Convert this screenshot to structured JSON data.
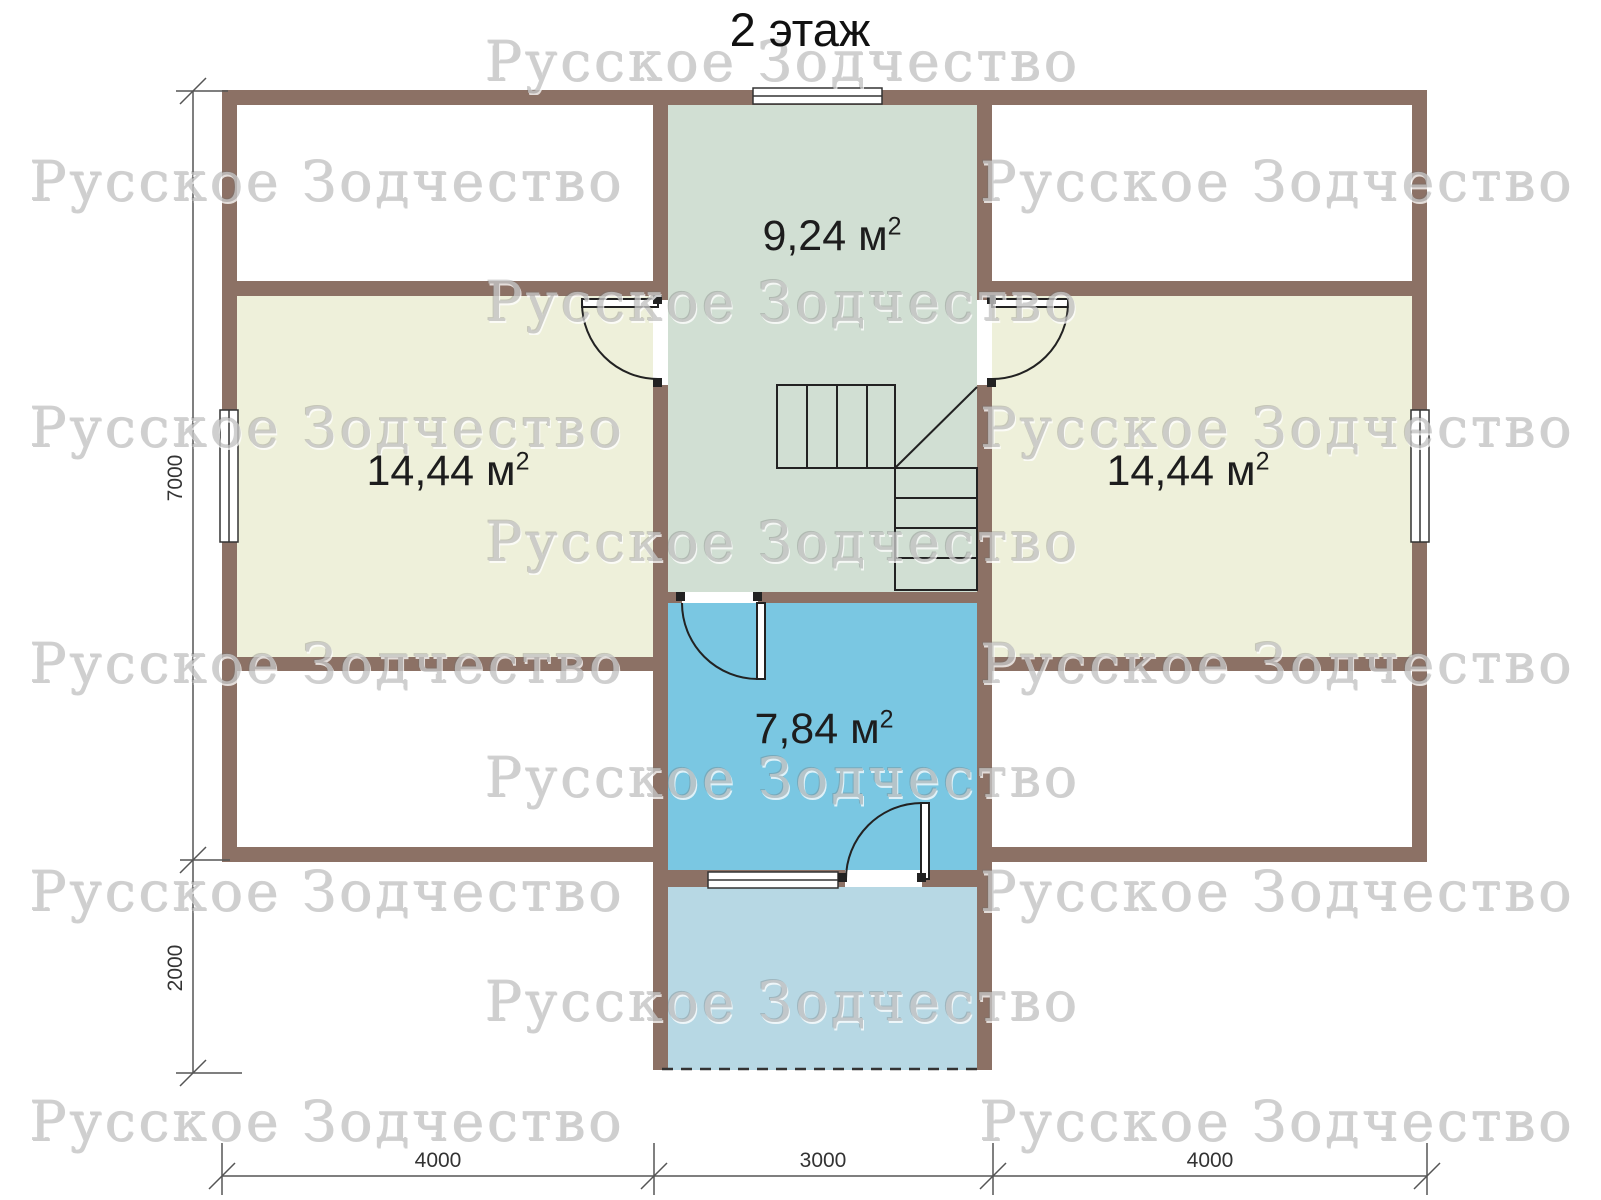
{
  "title": "2 этаж",
  "watermark_text": "Русское Зодчество",
  "rooms": {
    "hall": {
      "area": "9,24 м",
      "sup": "2"
    },
    "left": {
      "area": "14,44 м",
      "sup": "2"
    },
    "right": {
      "area": "14,44 м",
      "sup": "2"
    },
    "bath": {
      "area": "7,84 м",
      "sup": "2"
    }
  },
  "dimensions": {
    "vertical_main": "7000",
    "vertical_balcony": "2000",
    "bottom": [
      "4000",
      "3000",
      "4000"
    ]
  },
  "colors": {
    "wall": "#8c7165",
    "room_side": "#eef0da",
    "room_hall": "#d1dfd3",
    "room_bath": "#7ac7e2",
    "balcony": "#b7d8e4",
    "line": "#2a2a2a",
    "dim": "#555555",
    "text": "#1d1d1d",
    "watermark": "#c4c4c4"
  }
}
